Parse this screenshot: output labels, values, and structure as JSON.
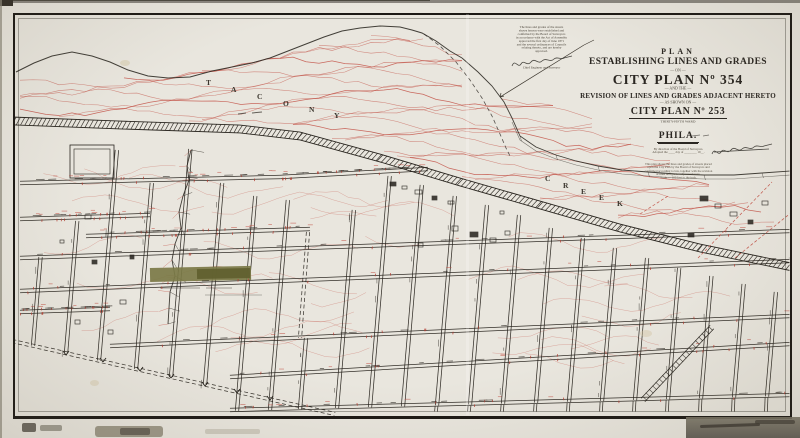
{
  "colors": {
    "paper": "#e9e6de",
    "ink": "#29251f",
    "red": "#c0493d",
    "tickred": "#b23c30",
    "green1": "#7b7a46",
    "green2": "#61602f",
    "border": "#1c1915"
  },
  "title_block": {
    "l1": "PLAN",
    "l2": "ESTABLISHING LINES AND GRADES",
    "l3": "— ON —",
    "l4": "CITY PLAN Nº 354",
    "l5": "— AND THE —",
    "l6": "REVISION OF LINES AND GRADES ADJACENT HERETO",
    "l7": "— AS SHOWN ON —",
    "l8": "CITY PLAN Nº 253",
    "l9": "THIRTY-FIFTH WARD",
    "l10": "PHILA.",
    "fine1": [
      "By direction of the Board of Surveyors.",
      "Adopted the ____ day of ________ 19__."
    ],
    "fine2": [
      "This plan shows the lines and grades of streets placed",
      "upon the City Plan by the Board of Surveyors and",
      "confirmed according to law, together with the revision",
      "of lines and grades adjacent thereto.",
      "Scale — 100 feet to the inch."
    ]
  },
  "notes": {
    "lines": [
      "The lines and grades of the streets",
      "shown hereon were established and",
      "confirmed by the Board of Surveyors",
      "in accordance with the Act of Assembly",
      "approved the first day of June 1871",
      "and the several ordinances of Councils",
      "relating thereto, and are hereby",
      "approved."
    ],
    "officer": "Chief Engineer and Surveyor"
  },
  "valley_label": {
    "word1": [
      {
        "ch": "T",
        "x": 206,
        "y": 78
      },
      {
        "ch": "A",
        "x": 231,
        "y": 85
      },
      {
        "ch": "C",
        "x": 257,
        "y": 92
      },
      {
        "ch": "O",
        "x": 283,
        "y": 99
      },
      {
        "ch": "N",
        "x": 309,
        "y": 105
      },
      {
        "ch": "Y",
        "x": 334,
        "y": 111
      }
    ],
    "word2": [
      {
        "ch": "C",
        "x": 545,
        "y": 174
      },
      {
        "ch": "R",
        "x": 563,
        "y": 181
      },
      {
        "ch": "E",
        "x": 581,
        "y": 187
      },
      {
        "ch": "E",
        "x": 599,
        "y": 193
      },
      {
        "ch": "K",
        "x": 617,
        "y": 199
      }
    ]
  },
  "map": {
    "rail": [
      [
        14,
        121
      ],
      [
        120,
        125
      ],
      [
        240,
        129
      ],
      [
        300,
        136
      ],
      [
        380,
        158
      ],
      [
        460,
        182
      ],
      [
        540,
        205
      ],
      [
        620,
        228
      ],
      [
        700,
        248
      ],
      [
        792,
        267
      ]
    ],
    "creek_a": [
      [
        16,
        72
      ],
      [
        34,
        63
      ],
      [
        52,
        56
      ],
      [
        72,
        52
      ],
      [
        92,
        56
      ],
      [
        110,
        62
      ],
      [
        128,
        70
      ],
      [
        148,
        76
      ],
      [
        168,
        78
      ],
      [
        190,
        77
      ],
      [
        212,
        71
      ],
      [
        232,
        67
      ],
      [
        252,
        63
      ],
      [
        270,
        58
      ],
      [
        288,
        51
      ],
      [
        306,
        44
      ],
      [
        324,
        37
      ],
      [
        342,
        31
      ],
      [
        360,
        28
      ],
      [
        380,
        26
      ],
      [
        400,
        27
      ],
      [
        412,
        30
      ],
      [
        422,
        33
      ],
      [
        436,
        41
      ],
      [
        450,
        51
      ],
      [
        462,
        58
      ]
    ],
    "creek_b": [
      [
        462,
        58
      ],
      [
        478,
        72
      ],
      [
        492,
        86
      ],
      [
        504,
        102
      ],
      [
        512,
        118
      ],
      [
        520,
        136
      ],
      [
        536,
        147
      ],
      [
        556,
        155
      ],
      [
        576,
        161
      ],
      [
        598,
        166
      ],
      [
        622,
        170
      ],
      [
        648,
        172
      ],
      [
        676,
        174
      ],
      [
        704,
        175
      ],
      [
        734,
        175
      ],
      [
        762,
        173
      ],
      [
        790,
        171
      ]
    ],
    "hill_dash": [
      [
        424,
        34
      ],
      [
        440,
        46
      ],
      [
        456,
        62
      ],
      [
        470,
        80
      ],
      [
        482,
        98
      ],
      [
        492,
        116
      ],
      [
        500,
        134
      ],
      [
        506,
        148
      ],
      [
        511,
        158
      ]
    ],
    "creek_left": [
      [
        191,
        150
      ],
      [
        187,
        166
      ],
      [
        189,
        180
      ],
      [
        183,
        196
      ],
      [
        179,
        212
      ],
      [
        181,
        228
      ],
      [
        175,
        244
      ],
      [
        172,
        260
      ],
      [
        175,
        276
      ],
      [
        170,
        292
      ],
      [
        169,
        308
      ],
      [
        168,
        324
      ]
    ],
    "h_streets": [
      [
        20,
        183,
        280,
        177
      ],
      [
        280,
        177,
        428,
        169
      ],
      [
        20,
        219,
        150,
        215
      ],
      [
        86,
        236,
        310,
        229
      ],
      [
        20,
        258,
        790,
        231
      ],
      [
        20,
        291,
        790,
        261
      ],
      [
        20,
        312,
        110,
        309
      ],
      [
        110,
        346,
        790,
        316
      ],
      [
        230,
        377,
        790,
        344
      ],
      [
        230,
        410,
        790,
        395
      ]
    ],
    "v_streets": [
      [
        33,
        257
      ],
      [
        66,
        221
      ],
      [
        99,
        150
      ],
      [
        136,
        183
      ],
      [
        171,
        149
      ],
      [
        205,
        183
      ],
      [
        237,
        196
      ],
      [
        270,
        200
      ],
      [
        300,
        338
      ],
      [
        337,
        210
      ],
      [
        370,
        176
      ],
      [
        403,
        185
      ],
      [
        437,
        196
      ],
      [
        470,
        205
      ],
      [
        503,
        215
      ],
      [
        536,
        228
      ],
      [
        569,
        238
      ],
      [
        602,
        248
      ],
      [
        635,
        258
      ],
      [
        668,
        268
      ],
      [
        701,
        276
      ],
      [
        734,
        284
      ],
      [
        767,
        292
      ]
    ],
    "dashed_streets": [
      [
        12,
        341,
        335,
        414
      ],
      [
        308,
        232,
        300,
        338
      ]
    ],
    "diag_street": [
      712,
      327,
      643,
      400
    ],
    "loop": [
      70,
      145,
      44,
      33
    ],
    "green_strip": {
      "x": 150,
      "y": 267,
      "w": 101,
      "h": 14
    },
    "buildings": [
      [
        390,
        182,
        6,
        4
      ],
      [
        402,
        186,
        5,
        3
      ],
      [
        415,
        190,
        7,
        4
      ],
      [
        432,
        196,
        5,
        4
      ],
      [
        448,
        201,
        6,
        3
      ],
      [
        452,
        226,
        6,
        5
      ],
      [
        470,
        232,
        8,
        5
      ],
      [
        490,
        238,
        6,
        4
      ],
      [
        505,
        231,
        5,
        4
      ],
      [
        700,
        196,
        8,
        5
      ],
      [
        715,
        204,
        6,
        4
      ],
      [
        730,
        212,
        7,
        4
      ],
      [
        748,
        220,
        5,
        4
      ],
      [
        762,
        201,
        6,
        4
      ],
      [
        85,
        215,
        6,
        4
      ],
      [
        92,
        260,
        5,
        4
      ],
      [
        120,
        300,
        6,
        4
      ],
      [
        75,
        320,
        5,
        4
      ],
      [
        130,
        255,
        4,
        4
      ],
      [
        418,
        243,
        5,
        4
      ],
      [
        500,
        211,
        4,
        3
      ],
      [
        688,
        233,
        6,
        4
      ],
      [
        60,
        240,
        4,
        3
      ],
      [
        108,
        330,
        5,
        4
      ]
    ],
    "red_dashed": [
      [
        698,
        258,
        772,
        182
      ],
      [
        735,
        258,
        792,
        212
      ],
      [
        640,
        214,
        668,
        196
      ]
    ],
    "chevrons": [
      [
        66,
        355
      ],
      [
        103,
        362
      ],
      [
        140,
        371
      ],
      [
        171,
        378
      ],
      [
        205,
        386
      ],
      [
        237,
        393
      ],
      [
        270,
        400
      ]
    ],
    "leader": [
      584,
      45,
      500,
      97
    ],
    "sig1": {
      "x": 512,
      "y": 58
    },
    "sig2": {
      "x": 712,
      "y": 146
    }
  }
}
